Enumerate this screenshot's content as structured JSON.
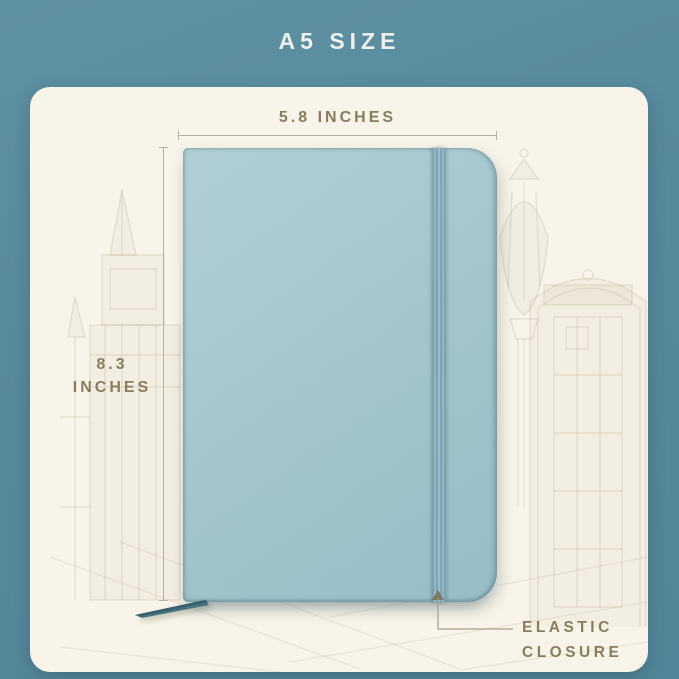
{
  "header": {
    "title": "A5 SIZE"
  },
  "annotations": {
    "width_label": "5.8 INCHES",
    "height_label_line1": "8.3",
    "height_label_line2": "INCHES",
    "elastic_label_line1": "ELASTIC",
    "elastic_label_line2": "CLOSURE"
  },
  "product": {
    "type": "a5-notebook",
    "features": [
      "elastic-closure",
      "bookmark-ribbon"
    ],
    "cover_color": "#9fc4ca",
    "elastic_band_color": "#86aab9",
    "bookmark_ribbon_color": "#47737f"
  },
  "background_sketch": [
    "big-ben-tower",
    "street-lamp",
    "london-phone-booth",
    "pavement-lines"
  ],
  "colors": {
    "background_teal": "#578a9c",
    "card_cream": "#f8f4e9",
    "annotation_text": "#8b7c5e",
    "annotation_line": "#b8b0a0",
    "header_text": "#eef0ec"
  }
}
